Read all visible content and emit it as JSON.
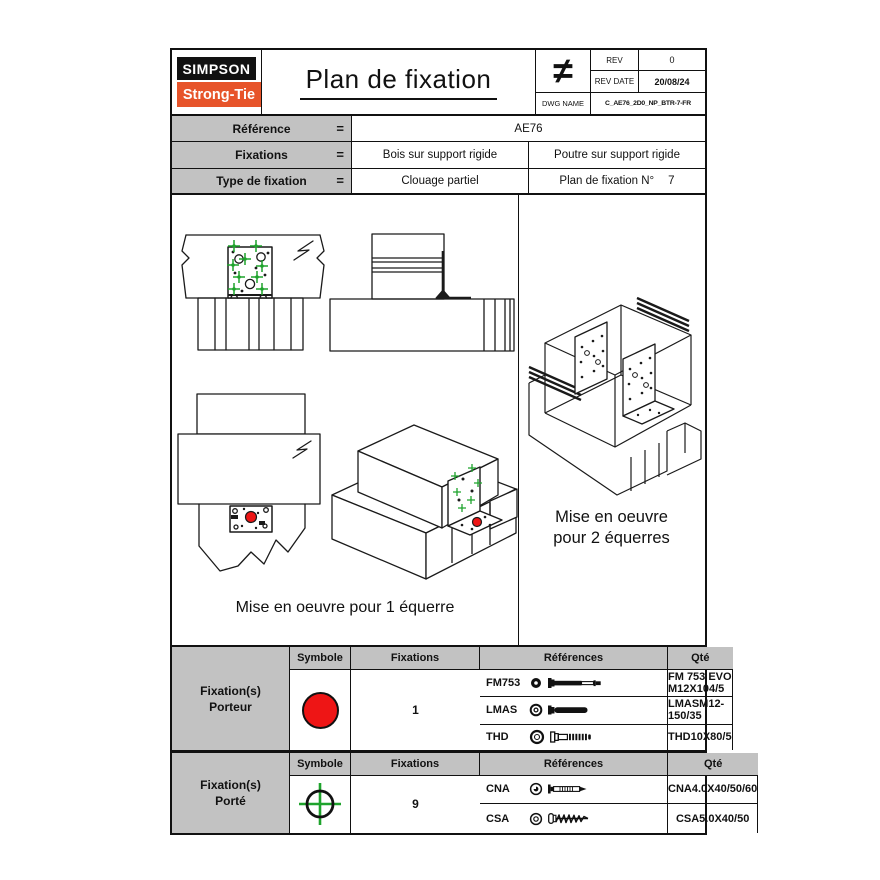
{
  "header": {
    "logo_line1": "SIMPSON",
    "logo_line2": "Strong-Tie",
    "title": "Plan de fixation",
    "projection_symbol": "≠",
    "rev": {
      "label": "REV",
      "value": "0"
    },
    "rev_date": {
      "label": "REV DATE",
      "value": "20/08/24"
    },
    "dwg": {
      "label": "DWG NAME",
      "value": "C_AE76_2D0_NP_BTR-7-FR"
    }
  },
  "info_table": {
    "rows": [
      {
        "label": "Référence",
        "eq": "=",
        "value": "AE76"
      },
      {
        "label": "Fixations",
        "eq": "=",
        "value_left": "Bois sur support rigide",
        "value_right": "Poutre sur support rigide"
      },
      {
        "label": "Type de fixation",
        "eq": "=",
        "value_left": "Clouage partiel",
        "value_right": "Plan de fixation N°",
        "number": "7"
      }
    ]
  },
  "drawings": {
    "caption_one": "Mise en oeuvre pour 1 équerre",
    "caption_two_line1": "Mise en oeuvre",
    "caption_two_line2": "pour 2 équerres"
  },
  "fixation_tables": [
    {
      "group_line1": "Fixation(s)",
      "group_line2": "Porteur",
      "headers": [
        "Symbole",
        "Fixations",
        "Références",
        "Qté"
      ],
      "symbol": {
        "name": "red-dot-symbol",
        "color": "#ee1515"
      },
      "rows": [
        {
          "code": "FM753",
          "end_icon": "bolt-end-view-icon",
          "side_icon": "fm753-bolt-icon",
          "reference": "FM 753 EVO M12X104/5"
        },
        {
          "code": "LMAS",
          "end_icon": "washer-end-view-icon",
          "side_icon": "lmas-bolt-icon",
          "reference": "LMASM12-150/35"
        },
        {
          "code": "THD",
          "end_icon": "ring-end-view-icon",
          "side_icon": "thd-screw-icon",
          "reference": "THD10X80/5"
        }
      ],
      "qty": "1"
    },
    {
      "group_line1": "Fixation(s)",
      "group_line2": "Porté",
      "headers": [
        "Symbole",
        "Fixations",
        "Références",
        "Qté"
      ],
      "symbol": {
        "name": "green-crosshair-symbol",
        "color": "#1ea32c"
      },
      "rows": [
        {
          "code": "CNA",
          "end_icon": "nail-head-end-view-icon",
          "side_icon": "cna-nail-icon",
          "reference": "CNA4.0X40/50/60"
        },
        {
          "code": "CSA",
          "end_icon": "screw-head-end-view-icon",
          "side_icon": "csa-screw-icon",
          "reference": "CSA5.0X40/50"
        }
      ],
      "qty": "9"
    }
  ],
  "colors": {
    "brand_orange": "#e7542a",
    "symbol_red": "#ee1515",
    "marker_green": "#1ea32c",
    "header_gray": "#c2c2c2",
    "line_black": "#111111"
  }
}
